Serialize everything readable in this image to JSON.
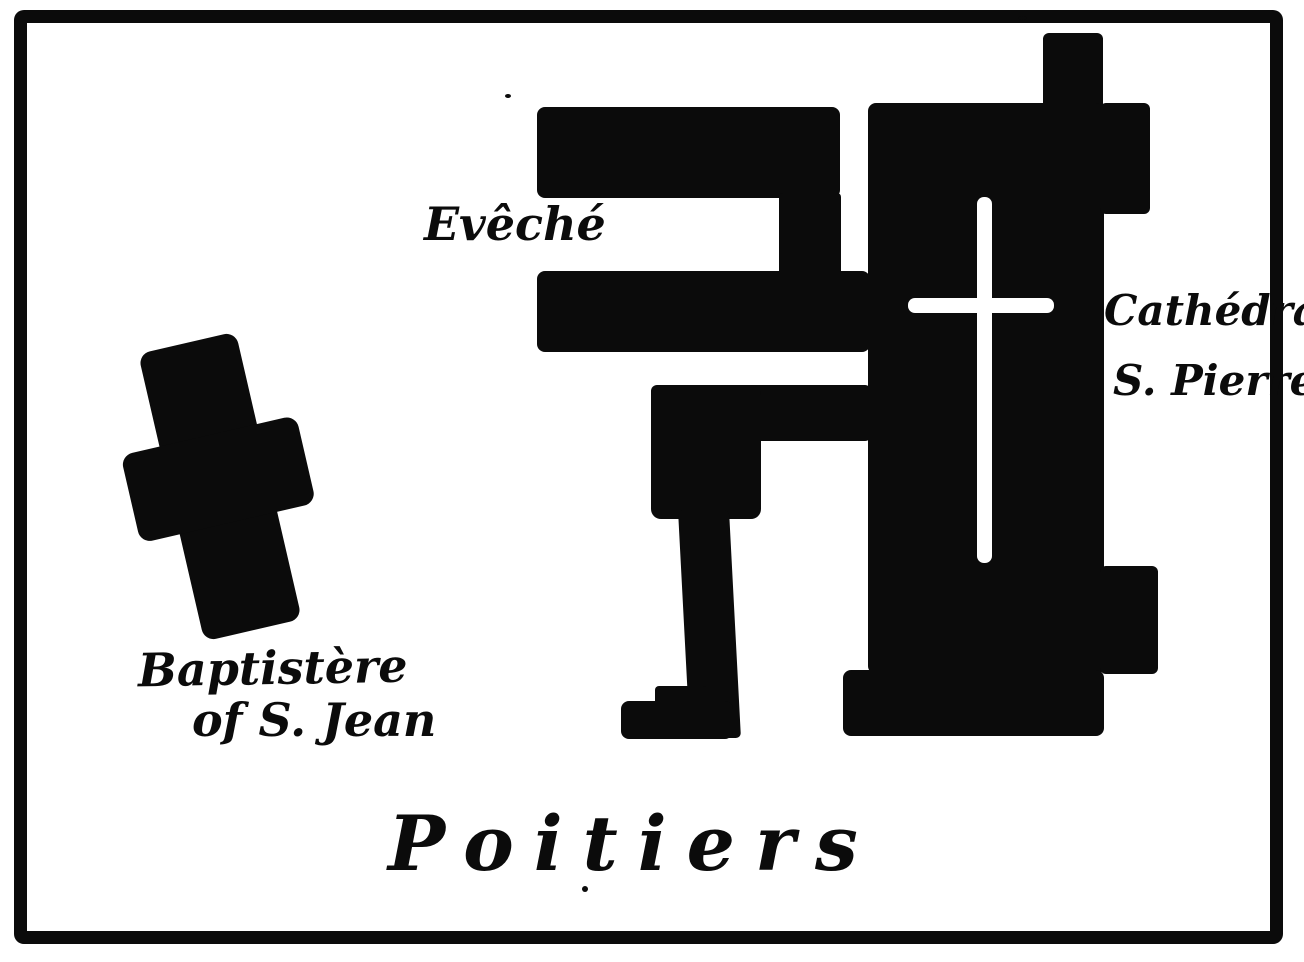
{
  "page": {
    "paper_color": "#ffffff",
    "ink_color": "#0b0b0b"
  },
  "map": {
    "title": "Poitiers",
    "labels": {
      "eveche": "Evêché",
      "cathedral_name": "Cathédral",
      "cathedral_dedication": "S. Pierre",
      "baptistere_name": "Baptistère",
      "baptistere_dedication": "of S. Jean"
    }
  }
}
